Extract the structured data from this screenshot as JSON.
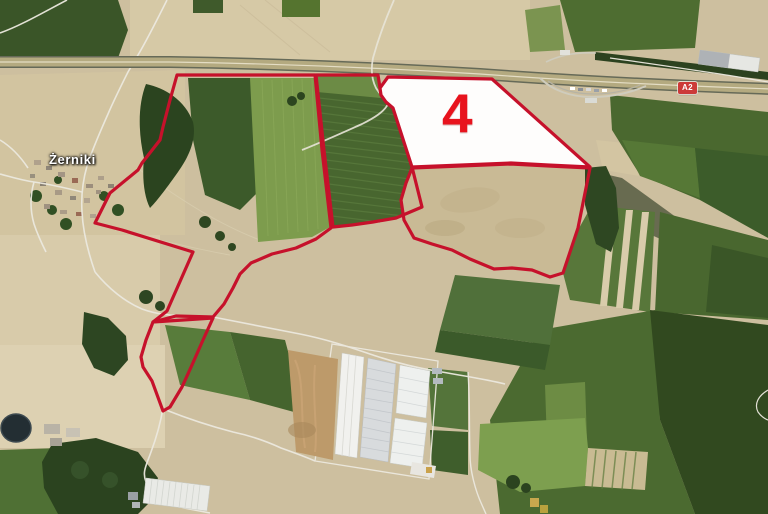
{
  "map": {
    "type": "satellite-aerial",
    "place_label": "Żerniki",
    "motorway_badge": "A2",
    "highlighted_parcel_number": "4",
    "colors": {
      "parcel_outline": "#c6112b",
      "parcel_number": "#e8131d",
      "parcel_fill": "#ffffff",
      "badge_background": "#cc3a38",
      "badge_text": "#ffffff",
      "place_label_text": "#ffffff"
    },
    "parcels": [
      {
        "id": "parcel-west",
        "points": "177,75 315,75 322,150 331,228 316,239 296,248 272,254 251,263 240,274 233,288 224,304 213,317 176,316 153,322 167,311 193,252 122,230 95,223 110,193 138,170 142,163 160,140 163,127 170,100"
      },
      {
        "id": "parcel-middle",
        "points": "316,75 378,75 380,88 381,95 386,102 393,108 412,167 422,207 396,218 373,222 352,225 333,227 324,150"
      },
      {
        "id": "parcel-4",
        "filled": true,
        "label": "4",
        "points": "388,77 492,79 590,167 548,165 511,163 412,167 393,108 386,102 381,95 380,88"
      },
      {
        "id": "parcel-southeast",
        "points": "412,168 511,164 549,166 590,168 578,228 563,273 550,277 532,270 512,268 494,269 470,259 452,250 432,244 414,238 404,220 401,200 406,183"
      },
      {
        "id": "parcel-south-small",
        "points": "153,322 213,318 203,340 192,365 182,387 170,407 163,411 152,381 143,367 141,357 146,340"
      }
    ]
  }
}
